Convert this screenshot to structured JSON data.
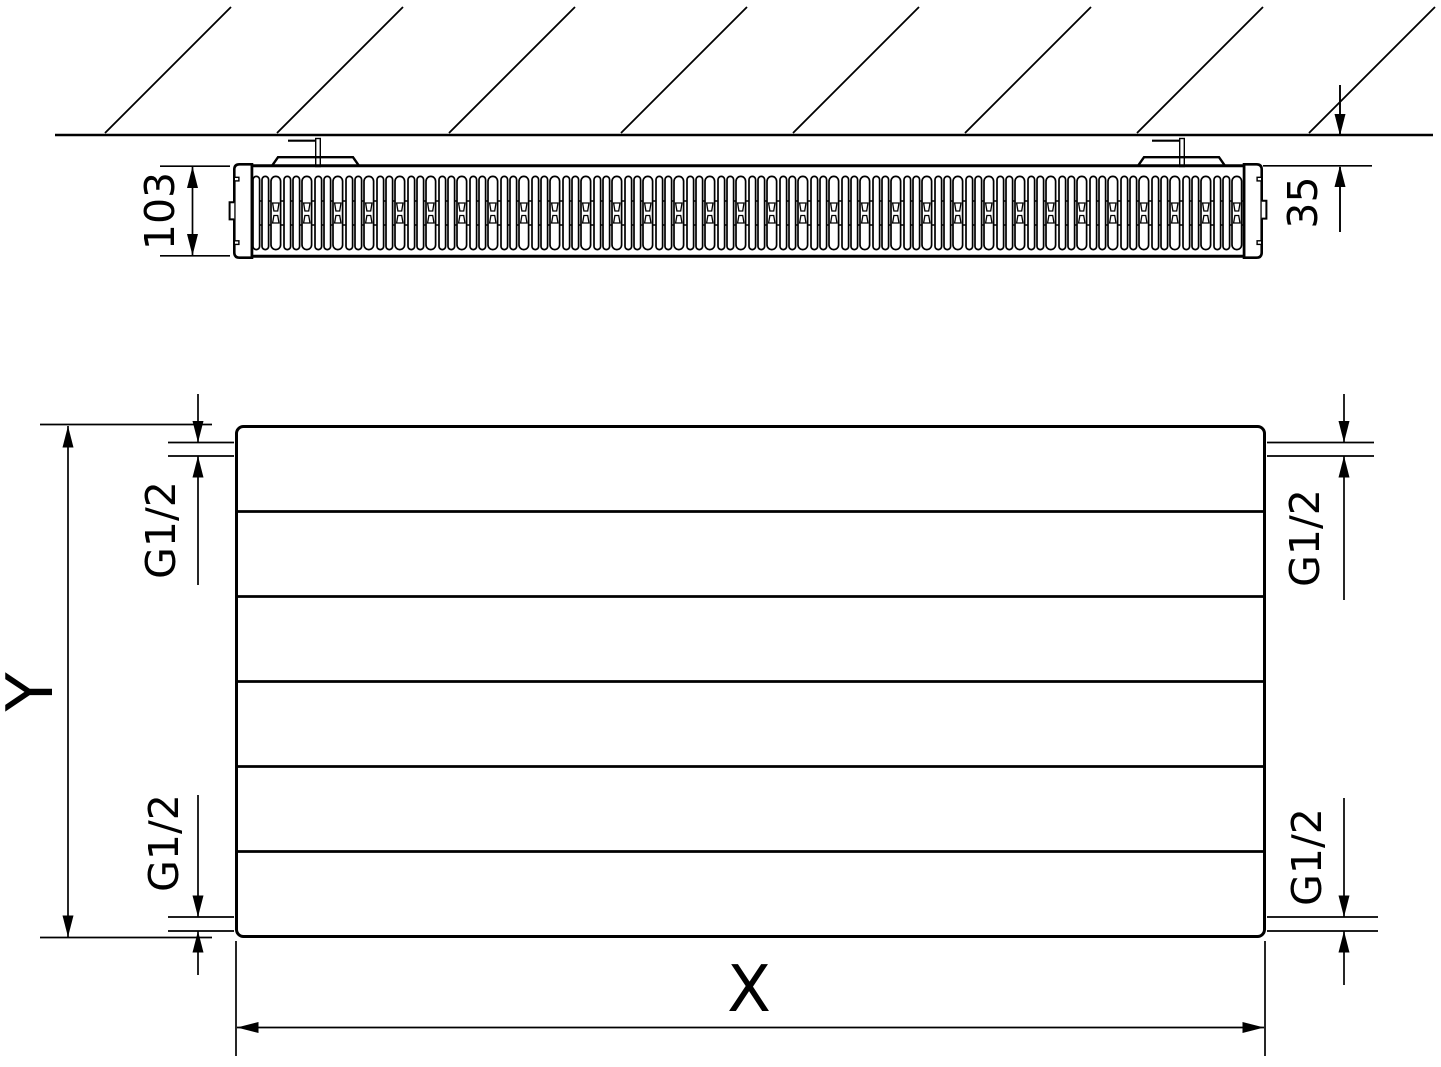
{
  "top_view": {
    "depth_dim": "103",
    "wall_gap_dim": "35"
  },
  "front_view": {
    "height_dim": "Y",
    "width_dim": "X",
    "connections": {
      "top_left": "G1/2",
      "bottom_left": "G1/2",
      "top_right": "G1/2",
      "bottom_right": "G1/2"
    }
  },
  "colors": {
    "ink": "#000000",
    "paper": "#ffffff"
  }
}
